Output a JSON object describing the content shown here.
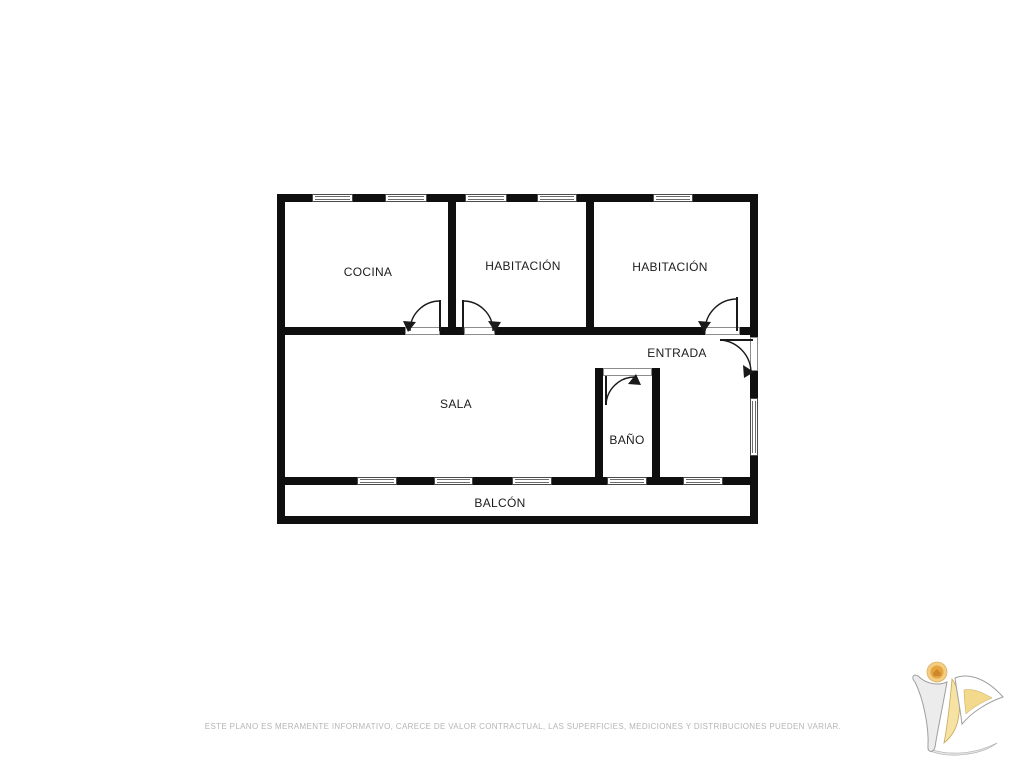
{
  "plan": {
    "rooms": [
      {
        "id": "cocina",
        "label": "COCINA"
      },
      {
        "id": "habitacion-1",
        "label": "HABITACIÓN"
      },
      {
        "id": "habitacion-2",
        "label": "HABITACIÓN"
      },
      {
        "id": "entrada",
        "label": "ENTRADA"
      },
      {
        "id": "sala",
        "label": "SALA"
      },
      {
        "id": "bano",
        "label": "BAÑO"
      },
      {
        "id": "balcon",
        "label": "BALCÓN"
      }
    ],
    "symbols": {
      "window": "window-symbol",
      "door_swing": "door-swing-symbol",
      "door_threshold": "door-threshold-symbol"
    }
  },
  "footer": {
    "disclaimer": "ESTE PLANO ES MERAMENTE INFORMATIVO, CARECE DE VALOR CONTRACTUAL, LAS SUPERFICIES, MEDICIONES Y DISTRIBUCIONES PUEDEN VARIAR."
  },
  "logo": {
    "name": "agency-logo"
  },
  "colors": {
    "background": "#ffffff",
    "wall": "#0f0f0f",
    "label": "#1c1c1c",
    "disclaimer": "#b5b5b5",
    "logo_orange": "#e8a43c",
    "logo_yellow": "#f6e3a4",
    "logo_gray": "#ececec"
  }
}
